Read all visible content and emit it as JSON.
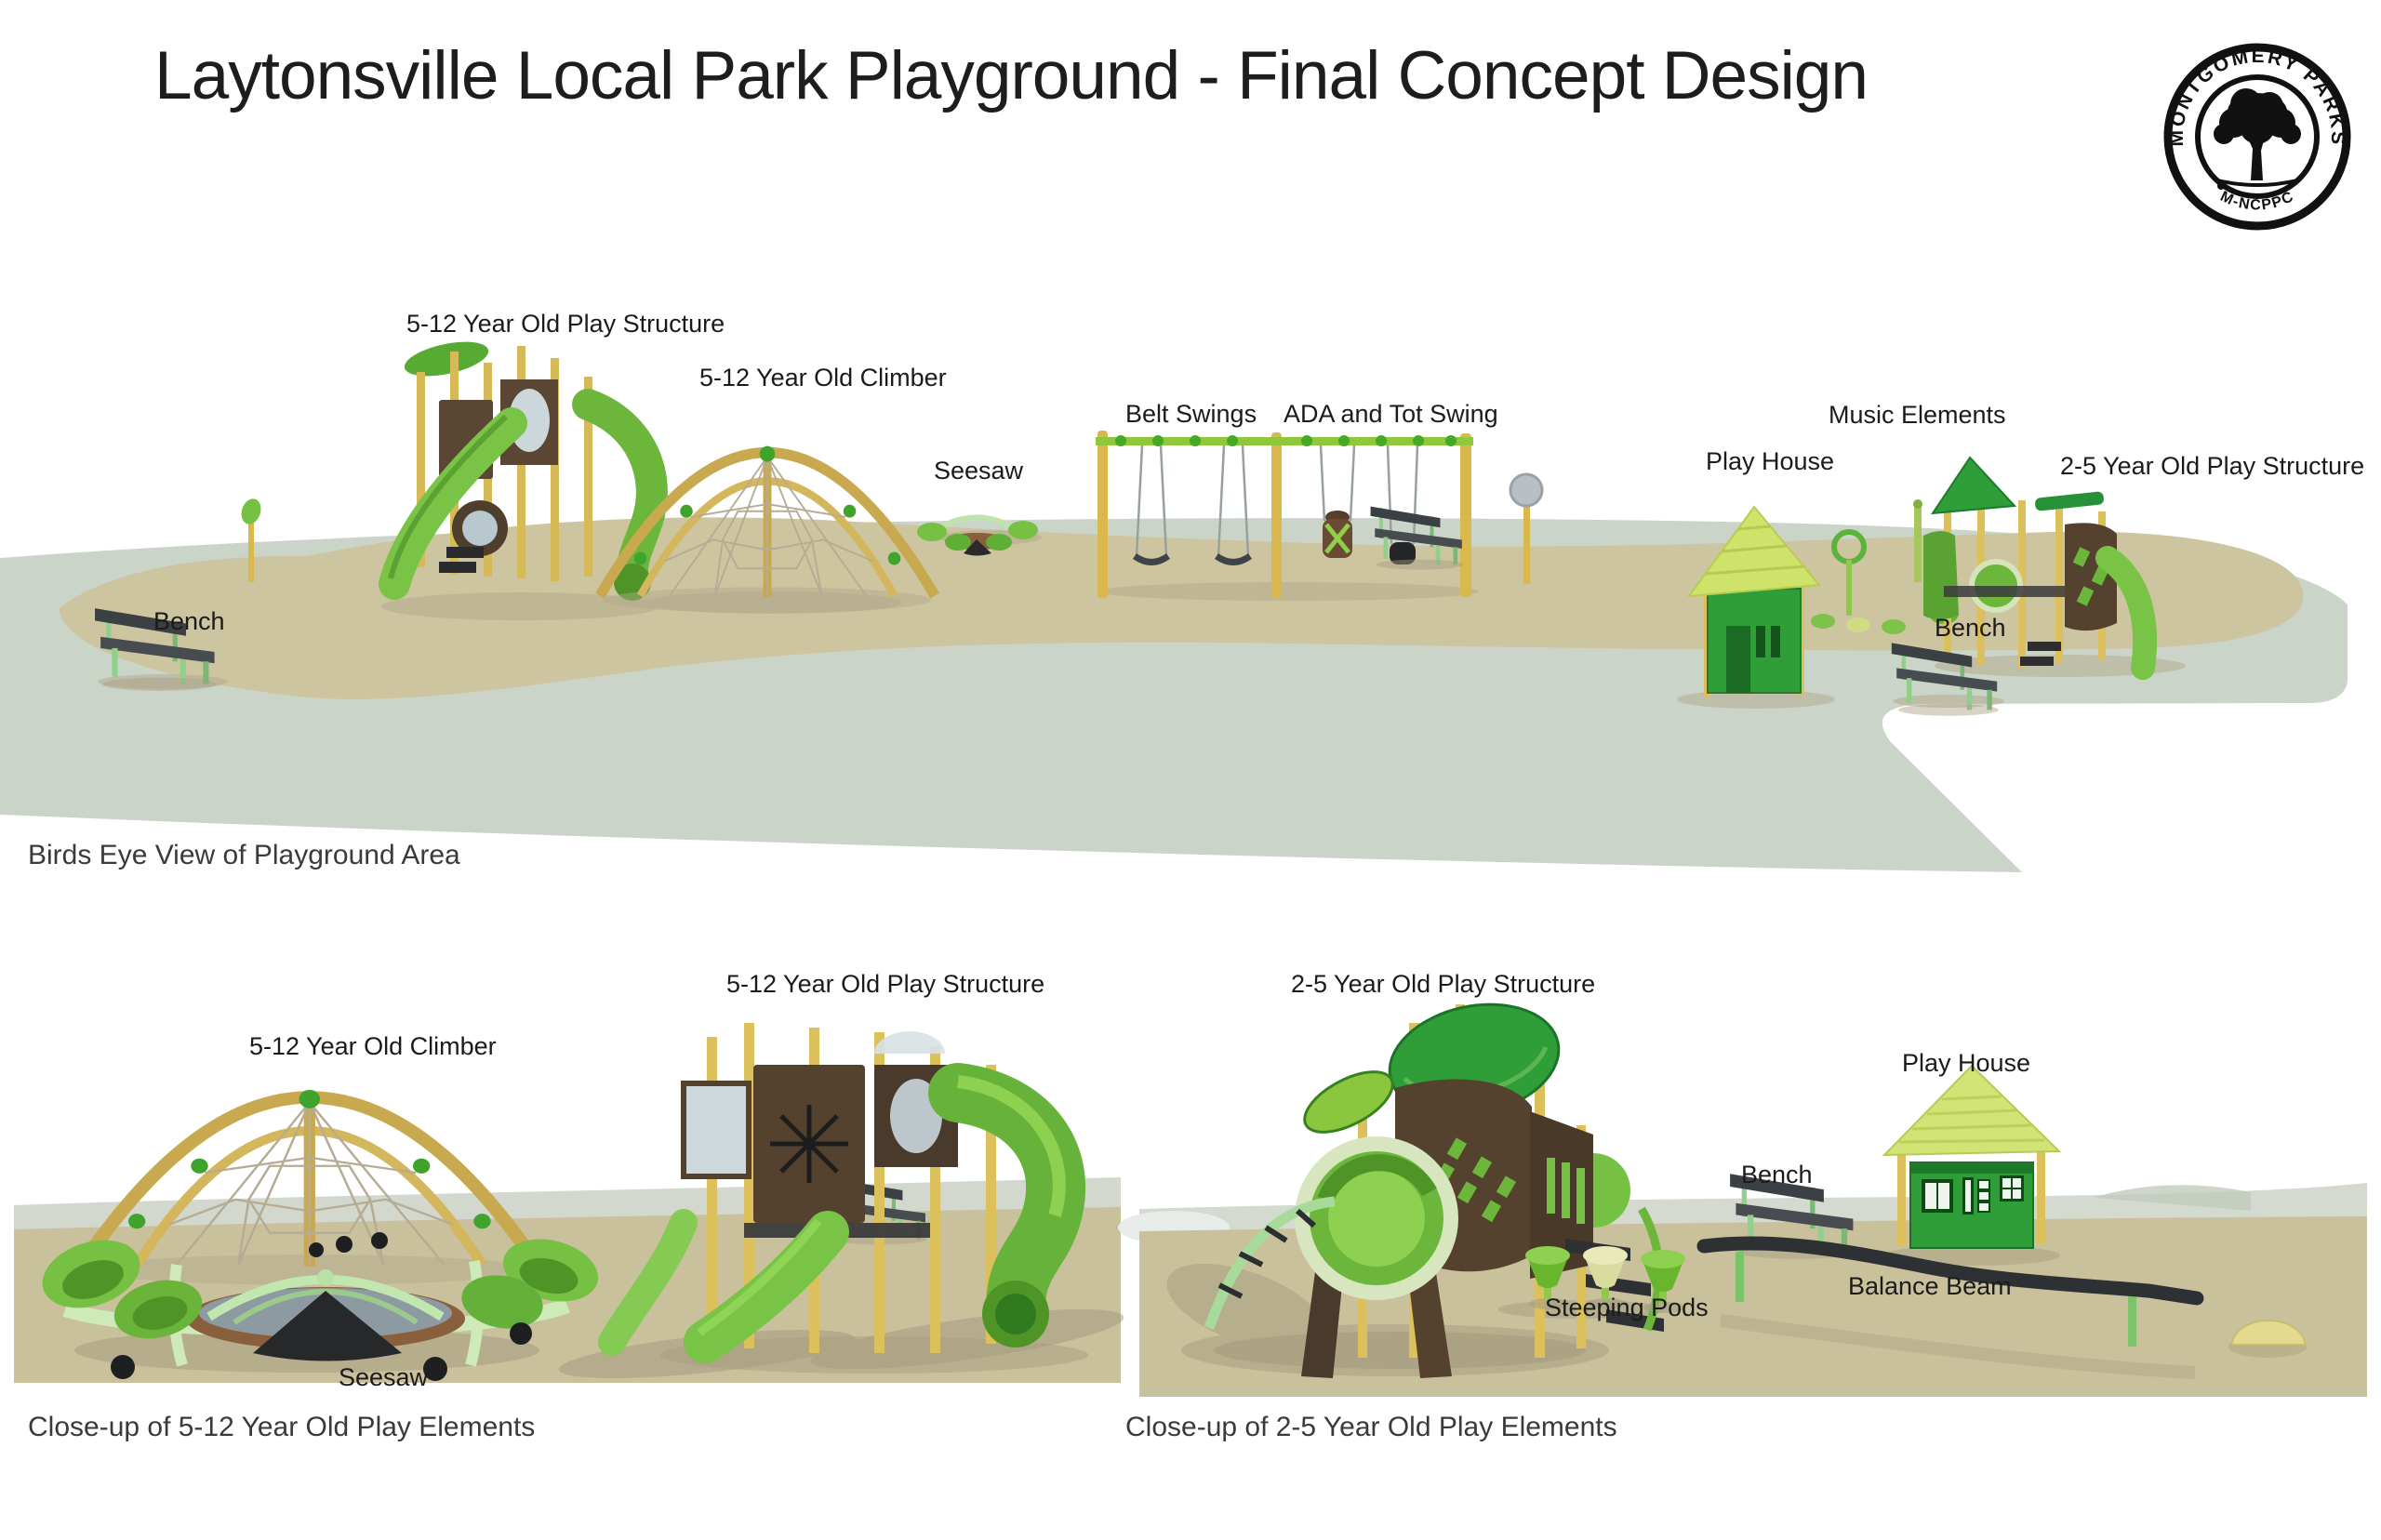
{
  "header": {
    "title": "Laytonsville Local Park Playground - Final Concept Design"
  },
  "logo": {
    "top_text": "MONTGOMERY PARKS",
    "bottom_text": "M-NCPPC"
  },
  "views": {
    "birdseye": {
      "caption": "Birds Eye View of Playground Area",
      "labels": [
        {
          "id": "play-structure-5-12",
          "text": "5-12 Year Old Play Structure"
        },
        {
          "id": "climber-5-12",
          "text": "5-12 Year Old Climber"
        },
        {
          "id": "seesaw",
          "text": "Seesaw"
        },
        {
          "id": "belt-swings",
          "text": "Belt Swings"
        },
        {
          "id": "ada-tot-swing",
          "text": "ADA and Tot Swing"
        },
        {
          "id": "music-elements",
          "text": "Music Elements"
        },
        {
          "id": "play-house",
          "text": "Play House"
        },
        {
          "id": "play-structure-2-5",
          "text": "2-5 Year Old Play Structure"
        },
        {
          "id": "bench-left",
          "text": "Bench"
        },
        {
          "id": "bench-right",
          "text": "Bench"
        }
      ]
    },
    "closeup_5_12": {
      "caption": "Close-up of 5-12 Year Old Play Elements",
      "labels": [
        {
          "id": "play-structure-5-12",
          "text": "5-12 Year Old Play Structure"
        },
        {
          "id": "climber-5-12",
          "text": "5-12 Year Old Climber"
        },
        {
          "id": "seesaw",
          "text": "Seesaw"
        }
      ]
    },
    "closeup_2_5": {
      "caption": "Close-up of 2-5 Year Old Play Elements",
      "labels": [
        {
          "id": "play-structure-2-5",
          "text": "2-5 Year Old Play Structure"
        },
        {
          "id": "play-house",
          "text": "Play House"
        },
        {
          "id": "bench",
          "text": "Bench"
        },
        {
          "id": "balance-beam",
          "text": "Balance Beam"
        },
        {
          "id": "steeping-pods",
          "text": "Steeping Pods"
        }
      ]
    }
  },
  "colors": {
    "walkway": "#cbd4c9",
    "sand": "#cdc4a0",
    "equip_green": "#76c043",
    "equip_dark_green": "#2f9e38",
    "lime_roof": "#cfe26a",
    "post_yellow": "#d9bc55",
    "panel_brown": "#54422e",
    "bench_dark": "#3b4045"
  }
}
